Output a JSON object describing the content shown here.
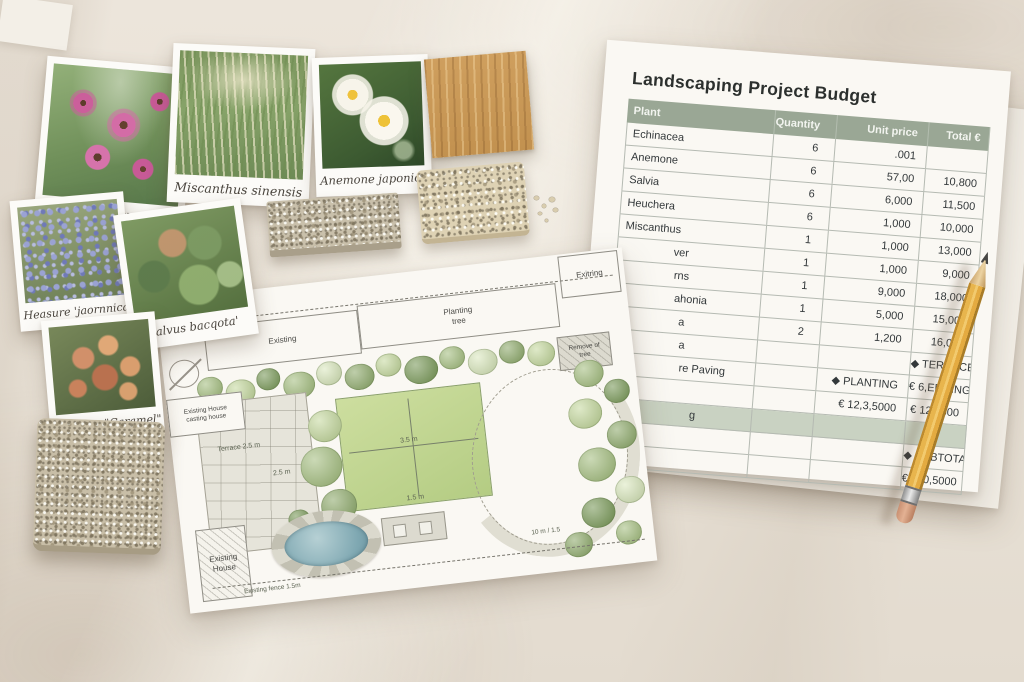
{
  "budget_sheet": {
    "title": "Landscaping Project Budget",
    "columns": [
      "Plant",
      "Quantity",
      "Unit price",
      "Total €"
    ],
    "rows": [
      {
        "plant": "Echinacea",
        "qty": "6",
        "unit": ".001",
        "total": ""
      },
      {
        "plant": "Anemone",
        "qty": "6",
        "unit": "57,00",
        "total": "10,800"
      },
      {
        "plant": "Salvia",
        "qty": "6",
        "unit": "6,000",
        "total": "11,500"
      },
      {
        "plant": "Heuchera",
        "qty": "6",
        "unit": "1,000",
        "total": "10,000"
      },
      {
        "plant": "Miscanthus",
        "qty": "1",
        "unit": "1,000",
        "total": "13,000"
      },
      {
        "plant": "ver",
        "qty": "1",
        "unit": "1,000",
        "total": "9,000"
      },
      {
        "plant": "rns",
        "qty": "1",
        "unit": "9,000",
        "total": "18,000"
      },
      {
        "plant": "ahonia",
        "qty": "1",
        "unit": "5,000",
        "total": "15,000"
      },
      {
        "plant": "a",
        "qty": "2",
        "unit": "1,200",
        "total": "16,000"
      },
      {
        "plant": "a",
        "qty": "",
        "unit": "",
        "total": "◆ TERRACE"
      },
      {
        "plant": "re Paving",
        "qty": "",
        "unit": "◆ PLANTING",
        "total": "€ 6,EDGING"
      },
      {
        "plant": "",
        "qty": "",
        "unit": "€ 12,3,5000",
        "total": "€ 125,500"
      },
      {
        "plant": "g",
        "qty": "",
        "unit": "",
        "total": "",
        "shaded": true
      },
      {
        "plant": "",
        "qty": "",
        "unit": "",
        "total": "◆ SUBTOTAL"
      },
      {
        "plant": "",
        "qty": "",
        "unit": "",
        "total": "€ 120,5000"
      }
    ]
  },
  "plant_cards": [
    {
      "label": "Echinaceea purpurea"
    },
    {
      "label": "Miscanthus sinensis"
    },
    {
      "label": "Anemone japonica"
    },
    {
      "label": "Heasure 'jaornnica"
    },
    {
      "label": "Salvus bacqota'"
    },
    {
      "label": "Haxtiera \"Caramel\""
    }
  ],
  "plan": {
    "existing_area": "Existing",
    "planting_tree": "Planting tree",
    "exitring": "Exitring",
    "remove_of_tree": "Remove of tree",
    "existing_house_note": "Existing House casting house",
    "terrace": "Terrace 2.5 m",
    "dim_2_5": "2.5 m",
    "lawn_w": "3.5 m",
    "lawn_h": "1.5 m",
    "existing_house": "Existing House",
    "fence": "Existing fence 1.5m",
    "scale": "10 m / 1.5"
  },
  "colors": {
    "header_green": "#9aa795",
    "row_shade": "#c9d2c2",
    "table_line": "#b5bab2",
    "pencil_yellow": "#e4ab41",
    "lawn_green": "#c3d795",
    "pond_blue": "#8fb4bd",
    "paper_white": "#faf8f3",
    "text_dark": "#33383a"
  }
}
